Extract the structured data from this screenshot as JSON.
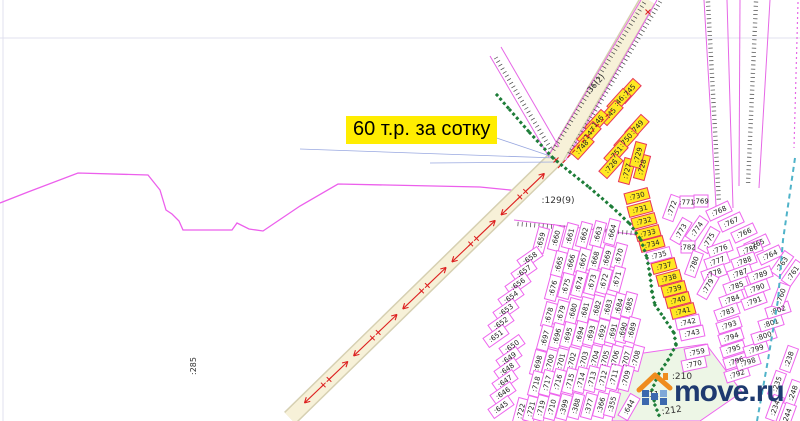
{
  "map": {
    "price_label": {
      "text": "60 т.р. за сотку",
      "bg": "#ffed00",
      "fg": "#000000"
    },
    "watermark": {
      "text": "move.ru",
      "text_color": "#1e3a70",
      "roof_color": "#ef8c1e",
      "house_color": "#3c68ae",
      "house_color_light": "#7fa8d8"
    },
    "colors": {
      "plot_border": "#ee66ee",
      "plot_yellow_fill": "#ffe822",
      "plot_yellow_border": "#e8365a",
      "boundary": "#ec5fec",
      "road_fill": "#f7f1d8",
      "road_edge": "#d6d0b2",
      "arrow_red": "#dd2020",
      "green_dots": "#1d7d38",
      "teal_dash": "#4fb3c9",
      "blue_line": "#99a8e0",
      "tick": "#444444",
      "faint_line": "#e0e0ef",
      "label_ink": "#333333",
      "green_area_fill": "#edf6e6"
    },
    "faint_lines": [
      [
        0,
        38,
        800,
        38
      ],
      [
        3,
        0,
        3,
        421
      ]
    ],
    "boundary_points": "0,203 28,192 78,173 148,175 160,190 166,210 172,214 179,221 183,230 232,230 237,223 249,229 263,231 300,206 338,184 480,187 530,192",
    "road": {
      "path": "M648,0 L556,158 L290,418",
      "arrow_line": [
        548,
        170,
        295,
        412
      ],
      "arrow_count": 10
    },
    "corridors": [
      {
        "lines": [
          [
            641,
            0,
            549,
            155
          ],
          [
            657,
            0,
            566,
            160
          ]
        ],
        "ticks": [
          [
            644,
            3,
            552,
            152
          ],
          [
            660,
            2,
            568,
            156
          ]
        ]
      },
      {
        "lines": [
          [
            490,
            56,
            549,
            157
          ],
          [
            501,
            47,
            559,
            147
          ]
        ],
        "ticks": [
          [
            496,
            58,
            552,
            151
          ]
        ]
      },
      {
        "lines": [
          [
            704,
            0,
            716,
            206
          ],
          [
            727,
            0,
            733,
            208
          ]
        ],
        "ticks": [
          [
            708,
            2,
            719,
            203
          ]
        ]
      },
      {
        "lines": [
          [
            740,
            0,
            739,
            186
          ],
          [
            770,
            0,
            759,
            188
          ]
        ],
        "ticks": [
          [
            756,
            2,
            748,
            185
          ]
        ]
      },
      {
        "lines": [
          [
            514,
            220,
            648,
            236
          ]
        ],
        "ticks": [
          [
            518,
            224,
            645,
            234
          ]
        ]
      }
    ],
    "dotted_magenta_line": [
      798,
      2,
      794,
      148
    ],
    "survey_red_dash": [
      558,
      168,
      612,
      110
    ],
    "red_x_marks": [
      [
        648,
        12
      ],
      [
        556,
        160
      ]
    ],
    "blue_lines": [
      [
        556,
        158,
        300,
        149
      ],
      [
        556,
        158,
        467,
        128
      ],
      [
        558,
        162,
        430,
        163
      ]
    ],
    "green_line_points": [
      497,
      95,
      510,
      110,
      530,
      133,
      553,
      158,
      570,
      172,
      590,
      188,
      612,
      207,
      630,
      224,
      641,
      240,
      647,
      258,
      650,
      275,
      652,
      292,
      655,
      305,
      664,
      318,
      674,
      333,
      676,
      345,
      668,
      360,
      658,
      375,
      652,
      390,
      655,
      405,
      660,
      418
    ],
    "teal_line_points": [
      795,
      158,
      783,
      240,
      778,
      300,
      768,
      360,
      757,
      421
    ],
    "green_area_points": "630,355 706,344 742,392 700,421 612,421 622,372",
    "area_labels": [
      {
        "t": ":129(9)",
        "x": 558,
        "y": 203,
        "r": 0,
        "s": 9
      },
      {
        "t": ":285",
        "x": 196,
        "y": 366,
        "r": -90,
        "s": 8
      },
      {
        "t": ":210",
        "x": 682,
        "y": 379,
        "r": 0,
        "s": 9
      },
      {
        "t": ":211",
        "x": 650,
        "y": 397,
        "r": 0,
        "s": 8
      },
      {
        "t": ":212",
        "x": 672,
        "y": 413,
        "r": -8,
        "s": 9
      },
      {
        "t": ":36(2)",
        "x": 597,
        "y": 86,
        "r": -48,
        "s": 8
      }
    ],
    "plots": [
      [
        ":745",
        629,
        91,
        -48,
        1
      ],
      [
        ":46",
        619,
        101,
        -48,
        1
      ],
      [
        ":45",
        611,
        113,
        -48,
        1
      ],
      [
        ":146",
        597,
        122,
        -48,
        1
      ],
      [
        ":147",
        589,
        134,
        -48,
        1
      ],
      [
        ":748",
        582,
        147,
        -48,
        1
      ],
      [
        ":749",
        637,
        127,
        -48,
        1
      ],
      [
        ":750",
        626,
        140,
        -48,
        1
      ],
      [
        ":751",
        616,
        153,
        -48,
        1
      ],
      [
        ":726",
        611,
        166,
        -48,
        1
      ],
      [
        ":727",
        627,
        171,
        -75,
        1
      ],
      [
        ":728",
        642,
        167,
        -75,
        1
      ],
      [
        ":729",
        638,
        155,
        -75,
        1
      ],
      [
        ":730",
        637,
        196,
        -15,
        1
      ],
      [
        ":731",
        640,
        209,
        -15,
        1
      ],
      [
        ":732",
        644,
        221,
        -15,
        1
      ],
      [
        ":733",
        648,
        233,
        -15,
        1
      ],
      [
        ":734",
        652,
        244,
        -15,
        1
      ],
      [
        ":735",
        659,
        255,
        -15,
        0
      ],
      [
        ":737",
        664,
        266,
        -15,
        1
      ],
      [
        ":738",
        669,
        278,
        -15,
        1
      ],
      [
        ":739",
        674,
        289,
        -15,
        1
      ],
      [
        ":740",
        678,
        300,
        -15,
        1
      ],
      [
        ":741",
        683,
        311,
        -15,
        1
      ],
      [
        ":742",
        688,
        322,
        -12,
        0
      ],
      [
        ":743",
        692,
        333,
        -12,
        0
      ],
      [
        ":759",
        697,
        352,
        -12,
        0
      ],
      [
        ":770",
        694,
        364,
        -12,
        0
      ],
      [
        ":772",
        672,
        208,
        -70,
        0
      ],
      [
        ":771",
        687,
        202,
        0,
        0
      ],
      [
        ":769",
        701,
        201,
        0,
        0
      ],
      [
        ":768",
        719,
        211,
        -25,
        0
      ],
      [
        ":767",
        731,
        222,
        -25,
        0
      ],
      [
        ":766",
        744,
        233,
        -25,
        0
      ],
      [
        ":765",
        757,
        244,
        -25,
        0
      ],
      [
        ":764",
        770,
        255,
        -25,
        0
      ],
      [
        ":763",
        782,
        264,
        -55,
        0
      ],
      [
        ":761",
        793,
        273,
        -55,
        0
      ],
      [
        ":773",
        681,
        231,
        -60,
        0
      ],
      [
        ":774",
        697,
        229,
        -55,
        0
      ],
      [
        ":775",
        709,
        240,
        -60,
        0
      ],
      [
        ":782",
        688,
        247,
        0,
        0
      ],
      [
        ":780",
        694,
        264,
        -70,
        0
      ],
      [
        ":776",
        720,
        249,
        -20,
        0
      ],
      [
        ":777",
        717,
        261,
        -20,
        0
      ],
      [
        ":778",
        714,
        273,
        -20,
        0
      ],
      [
        ":779",
        708,
        286,
        -60,
        0
      ],
      [
        ":786",
        750,
        249,
        -20,
        0
      ],
      [
        ":788",
        744,
        261,
        -20,
        0
      ],
      [
        ":787",
        740,
        273,
        -20,
        0
      ],
      [
        ":785",
        736,
        286,
        -20,
        0
      ],
      [
        ":784",
        732,
        299,
        -20,
        0
      ],
      [
        ":783",
        727,
        312,
        -20,
        0
      ],
      [
        ":789",
        760,
        275,
        -20,
        0
      ],
      [
        ":790",
        757,
        288,
        -20,
        0
      ],
      [
        ":791",
        754,
        301,
        -20,
        0
      ],
      [
        ":793",
        729,
        325,
        -18,
        0
      ],
      [
        ":794",
        731,
        337,
        -18,
        0
      ],
      [
        ":795",
        733,
        349,
        -18,
        0
      ],
      [
        ":796",
        736,
        361,
        -18,
        0
      ],
      [
        ":792",
        737,
        374,
        -18,
        0
      ],
      [
        ":798",
        748,
        362,
        -18,
        0
      ],
      [
        ":799",
        756,
        349,
        -18,
        0
      ],
      [
        ":800",
        764,
        336,
        -18,
        0
      ],
      [
        ":801",
        771,
        323,
        -18,
        0
      ],
      [
        ":802",
        778,
        310,
        -18,
        0
      ],
      [
        ":760",
        781,
        296,
        -70,
        0
      ],
      [
        ":238",
        789,
        359,
        -70,
        0
      ],
      [
        ":235",
        777,
        384,
        -70,
        0
      ],
      [
        ":248",
        793,
        393,
        -70,
        0
      ],
      [
        ":234",
        775,
        408,
        -70,
        0
      ],
      [
        ":244",
        787,
        416,
        -70,
        0
      ],
      [
        ":659",
        541,
        240,
        -75,
        0
      ],
      [
        ":660",
        556,
        238,
        -75,
        0
      ],
      [
        ":661",
        570,
        236,
        -75,
        0
      ],
      [
        ":662",
        584,
        235,
        -75,
        0
      ],
      [
        ":663",
        598,
        234,
        -75,
        0
      ],
      [
        ":664",
        612,
        232,
        -75,
        0
      ],
      [
        ":658",
        530,
        258,
        -35,
        0
      ],
      [
        ":657",
        524,
        271,
        -35,
        0
      ],
      [
        ":656",
        518,
        284,
        -35,
        0
      ],
      [
        ":654",
        511,
        297,
        -35,
        0
      ],
      [
        ":653",
        506,
        310,
        -35,
        0
      ],
      [
        ":652",
        501,
        323,
        -35,
        0
      ],
      [
        ":651",
        496,
        336,
        -35,
        0
      ],
      [
        ":650",
        512,
        346,
        -35,
        0
      ],
      [
        ":649",
        509,
        358,
        -35,
        0
      ],
      [
        ":648",
        507,
        369,
        -35,
        0
      ],
      [
        ":647",
        505,
        381,
        -35,
        0
      ],
      [
        ":646",
        503,
        393,
        -35,
        0
      ],
      [
        ":645",
        501,
        407,
        -35,
        0
      ],
      [
        ":665",
        559,
        264,
        -75,
        0
      ],
      [
        ":666",
        571,
        262,
        -75,
        0
      ],
      [
        ":667",
        583,
        261,
        -75,
        0
      ],
      [
        ":668",
        595,
        259,
        -75,
        0
      ],
      [
        ":669",
        607,
        258,
        -75,
        0
      ],
      [
        ":670",
        619,
        256,
        -75,
        0
      ],
      [
        ":676",
        553,
        288,
        -75,
        0
      ],
      [
        ":675",
        566,
        286,
        -75,
        0
      ],
      [
        ":674",
        579,
        284,
        -75,
        0
      ],
      [
        ":673",
        592,
        282,
        -75,
        0
      ],
      [
        ":672",
        604,
        281,
        -75,
        0
      ],
      [
        ":671",
        617,
        279,
        -75,
        0
      ],
      [
        ":678",
        549,
        315,
        -75,
        0
      ],
      [
        ":679",
        561,
        313,
        -75,
        0
      ],
      [
        ":680",
        573,
        311,
        -75,
        0
      ],
      [
        ":681",
        585,
        310,
        -75,
        0
      ],
      [
        ":682",
        597,
        308,
        -75,
        0
      ],
      [
        ":683",
        608,
        307,
        -75,
        0
      ],
      [
        ":684",
        619,
        306,
        -75,
        0
      ],
      [
        ":685",
        629,
        305,
        -75,
        0
      ],
      [
        ":697",
        545,
        338,
        -75,
        0
      ],
      [
        ":696",
        557,
        336,
        -75,
        0
      ],
      [
        ":695",
        568,
        335,
        -75,
        0
      ],
      [
        ":694",
        580,
        334,
        -75,
        0
      ],
      [
        ":693",
        591,
        333,
        -75,
        0
      ],
      [
        ":692",
        602,
        332,
        -75,
        0
      ],
      [
        ":691",
        613,
        331,
        -75,
        0
      ],
      [
        ":690",
        623,
        330,
        -75,
        0
      ],
      [
        ":689",
        632,
        330,
        -75,
        0
      ],
      [
        ":698",
        538,
        363,
        -75,
        0
      ],
      [
        ":700",
        550,
        362,
        -75,
        0
      ],
      [
        ":701",
        561,
        361,
        -75,
        0
      ],
      [
        ":702",
        572,
        360,
        -75,
        0
      ],
      [
        ":703",
        584,
        359,
        -75,
        0
      ],
      [
        ":704",
        595,
        358,
        -75,
        0
      ],
      [
        ":705",
        605,
        358,
        -75,
        0
      ],
      [
        ":706",
        615,
        358,
        -75,
        0
      ],
      [
        ":707",
        626,
        359,
        -75,
        0
      ],
      [
        ":708",
        636,
        358,
        -75,
        0
      ],
      [
        ":718",
        536,
        384,
        -75,
        0
      ],
      [
        ":717",
        547,
        383,
        -75,
        0
      ],
      [
        ":716",
        558,
        382,
        -75,
        0
      ],
      [
        ":715",
        570,
        381,
        -75,
        0
      ],
      [
        ":714",
        581,
        380,
        -75,
        0
      ],
      [
        ":713",
        592,
        379,
        -75,
        0
      ],
      [
        ":712",
        603,
        378,
        -75,
        0
      ],
      [
        ":711",
        614,
        377,
        -75,
        0
      ],
      [
        ":709",
        626,
        378,
        -75,
        0
      ],
      [
        ":722",
        521,
        411,
        -75,
        0
      ],
      [
        ":721",
        531,
        409,
        -75,
        0
      ],
      [
        ":719",
        541,
        408,
        -75,
        0
      ],
      [
        ":710",
        552,
        407,
        -75,
        0
      ],
      [
        ":399",
        564,
        407,
        -75,
        0
      ],
      [
        ":388",
        576,
        406,
        -75,
        0
      ],
      [
        ":377",
        589,
        406,
        -75,
        0
      ],
      [
        ":366",
        601,
        405,
        -75,
        0
      ],
      [
        ":355",
        612,
        404,
        -75,
        0
      ],
      [
        ":644",
        629,
        407,
        -60,
        0
      ]
    ]
  }
}
